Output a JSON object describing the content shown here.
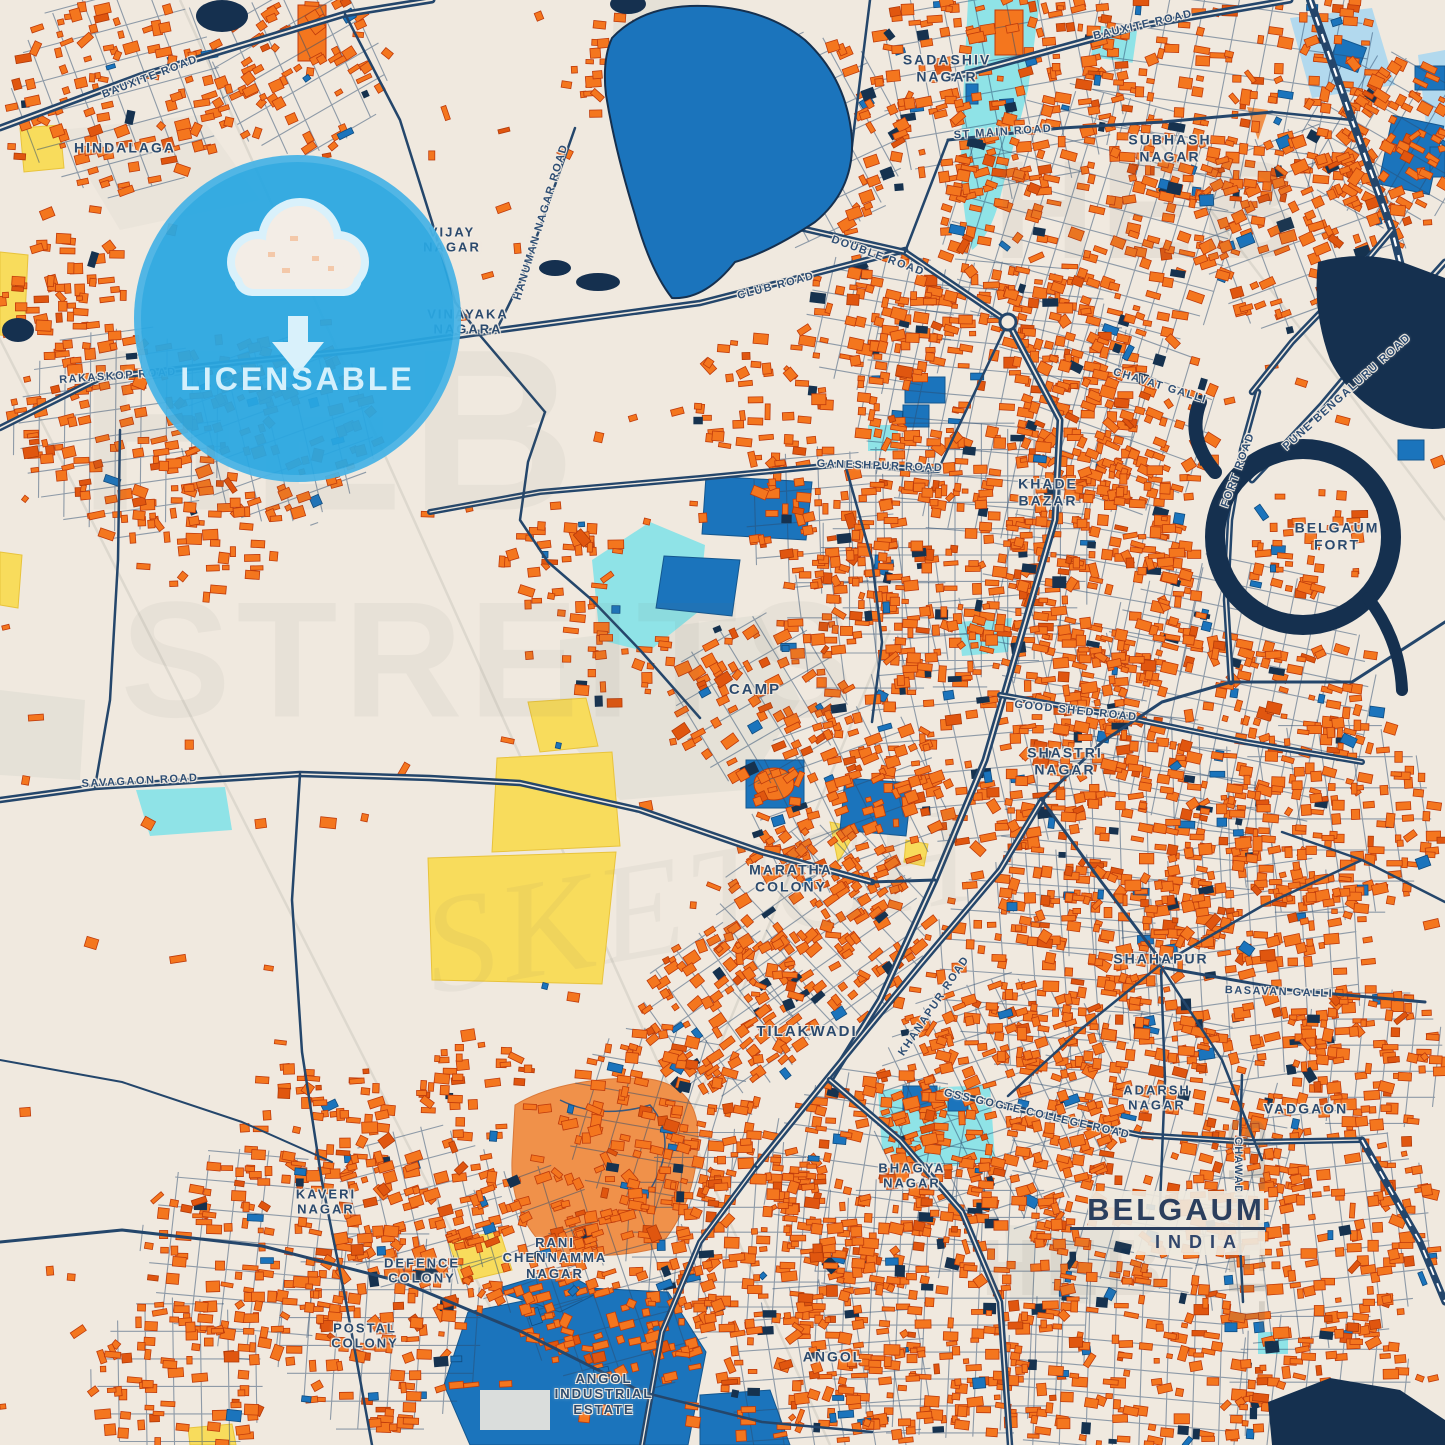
{
  "map": {
    "title_card": {
      "title": "BELGAUM",
      "subtitle": "INDIA"
    },
    "badge": {
      "label": "LICENSABLE",
      "icon": "cloud-download-icon"
    },
    "colors": {
      "background": "#F0E9DF",
      "building_orange": "#F4761E",
      "building_stroke": "#BF3B0C",
      "road_navy": "#24466B",
      "water_blue": "#1B74BC",
      "water_dark_navy": "#15304F",
      "pool_cyan": "#8FE3E7",
      "field_yellow": "#F8DC5C",
      "grey_zone": "#E2DDD4",
      "badge_blue": "#29A7E1",
      "badge_light": "#D9F1FB",
      "label_navy": "#2B4A6E"
    },
    "place_labels": [
      {
        "lines": [
          "HINDALAGA"
        ],
        "x": 125,
        "y": 148,
        "fs": 14
      },
      {
        "lines": [
          "SADASHIV",
          "NAGAR"
        ],
        "x": 947,
        "y": 68,
        "fs": 14
      },
      {
        "lines": [
          "SUBHASH",
          "NAGAR"
        ],
        "x": 1170,
        "y": 148,
        "fs": 14
      },
      {
        "lines": [
          "VIJAY",
          "NAGAR"
        ],
        "x": 452,
        "y": 240,
        "fs": 13
      },
      {
        "lines": [
          "VINAYAKA",
          "NAGARA"
        ],
        "x": 468,
        "y": 322,
        "fs": 13
      },
      {
        "lines": [
          "KHADE",
          "BAZAR"
        ],
        "x": 1048,
        "y": 492,
        "fs": 14
      },
      {
        "lines": [
          "BELGAUM",
          "FORT"
        ],
        "x": 1337,
        "y": 536,
        "fs": 14
      },
      {
        "lines": [
          "CAMP"
        ],
        "x": 755,
        "y": 690,
        "fs": 15
      },
      {
        "lines": [
          "SHASTRI",
          "NAGAR"
        ],
        "x": 1065,
        "y": 761,
        "fs": 14
      },
      {
        "lines": [
          "MARATHA",
          "COLONY"
        ],
        "x": 791,
        "y": 878,
        "fs": 14
      },
      {
        "lines": [
          "SHAHAPUR"
        ],
        "x": 1161,
        "y": 959,
        "fs": 14
      },
      {
        "lines": [
          "TILAKWADI"
        ],
        "x": 807,
        "y": 1032,
        "fs": 15
      },
      {
        "lines": [
          "ADARSH",
          "NAGAR"
        ],
        "x": 1157,
        "y": 1098,
        "fs": 13
      },
      {
        "lines": [
          "VADGAON"
        ],
        "x": 1306,
        "y": 1109,
        "fs": 14
      },
      {
        "lines": [
          "BHAGYA",
          "NAGAR"
        ],
        "x": 912,
        "y": 1176,
        "fs": 13
      },
      {
        "lines": [
          "KAVERI",
          "NAGAR"
        ],
        "x": 326,
        "y": 1202,
        "fs": 13
      },
      {
        "lines": [
          "DEFENCE",
          "COLONY"
        ],
        "x": 422,
        "y": 1271,
        "fs": 13
      },
      {
        "lines": [
          "RANI",
          "CHENNAMMA",
          "NAGAR"
        ],
        "x": 555,
        "y": 1258,
        "fs": 13
      },
      {
        "lines": [
          "POSTAL",
          "COLONY"
        ],
        "x": 365,
        "y": 1336,
        "fs": 13
      },
      {
        "lines": [
          "ANGOL",
          "INDUSTRIAL",
          "ESTATE"
        ],
        "x": 604,
        "y": 1394,
        "fs": 13
      },
      {
        "lines": [
          "ANGOL"
        ],
        "x": 833,
        "y": 1357,
        "fs": 14
      }
    ],
    "road_labels": [
      {
        "text": "BAUXITE ROAD",
        "x": 150,
        "y": 77,
        "rot": -21
      },
      {
        "text": "BAUXITE ROAD",
        "x": 1143,
        "y": 25,
        "rot": -13
      },
      {
        "text": "HANUMAN NAGAR ROAD",
        "x": 541,
        "y": 222,
        "rot": -73
      },
      {
        "text": "RAKASKOP ROAD",
        "x": 118,
        "y": 376,
        "rot": -4
      },
      {
        "text": "CLUB ROAD",
        "x": 776,
        "y": 286,
        "rot": -15
      },
      {
        "text": "DOUBLE ROAD",
        "x": 878,
        "y": 256,
        "rot": 20
      },
      {
        "text": "GANESHPUR ROAD",
        "x": 880,
        "y": 466,
        "rot": 2
      },
      {
        "text": "CHAVAT GALLI",
        "x": 1160,
        "y": 386,
        "rot": 17
      },
      {
        "text": "PUNE BENGALURU ROAD",
        "x": 1347,
        "y": 392,
        "rot": -42
      },
      {
        "text": "FORT ROAD",
        "x": 1238,
        "y": 470,
        "rot": -70
      },
      {
        "text": "ST MAIN ROAD",
        "x": 1003,
        "y": 132,
        "rot": -4
      },
      {
        "text": "SAVAGAON ROAD",
        "x": 140,
        "y": 781,
        "rot": -3
      },
      {
        "text": "GOOD SHED ROAD",
        "x": 1076,
        "y": 711,
        "rot": 6
      },
      {
        "text": "KHANAPUR ROAD",
        "x": 934,
        "y": 1006,
        "rot": -56
      },
      {
        "text": "GSS GOGTE COLLEGE ROAD",
        "x": 1037,
        "y": 1114,
        "rot": 13
      },
      {
        "text": "BASAVAN GALLI",
        "x": 1279,
        "y": 992,
        "rot": 2
      },
      {
        "text": "CHAWADI",
        "x": 1238,
        "y": 1168,
        "rot": 90
      }
    ],
    "watermarks": [
      {
        "text": "HEB",
        "x": 330,
        "y": 430,
        "fs": 230,
        "rot": 0,
        "op": 0.06,
        "italic": false
      },
      {
        "text": "STREITS",
        "x": 490,
        "y": 660,
        "fs": 165,
        "rot": 0,
        "op": 0.06,
        "italic": false
      },
      {
        "text": "SKETCH",
        "x": 700,
        "y": 900,
        "fs": 140,
        "rot": -10,
        "op": 0.06,
        "italic": true
      },
      {
        "text": "HEB",
        "x": 1150,
        "y": 210,
        "fs": 140,
        "rot": 0,
        "op": 0.07,
        "italic": false
      },
      {
        "text": "STREIT",
        "x": 1246,
        "y": 1228,
        "fs": 52,
        "rot": 90,
        "op": 0.2,
        "italic": false
      },
      {
        "text": "HEB",
        "x": 1075,
        "y": 1268,
        "fs": 80,
        "rot": 0,
        "op": 0.08,
        "italic": false
      }
    ]
  }
}
